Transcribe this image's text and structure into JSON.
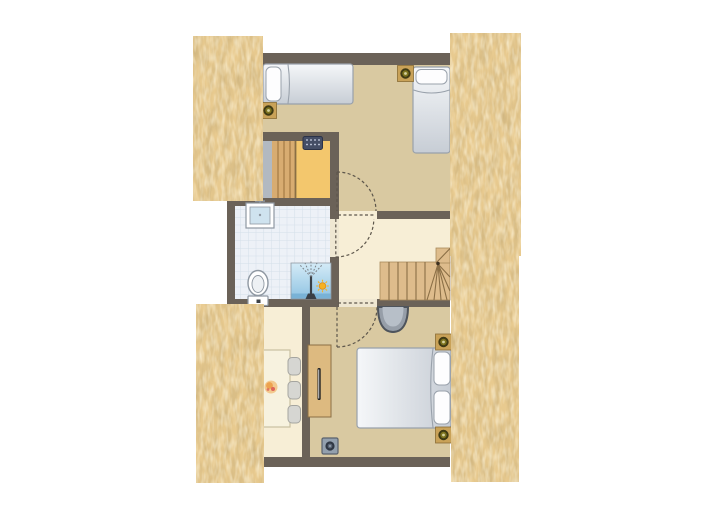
{
  "title_visible_text": "",
  "colors": {
    "bg": "#ffffff",
    "wall": "#6b6258",
    "floor_tan": "#d9c9a1",
    "floor_cream": "#f7eed6",
    "threshold": "#efe7d2",
    "sauna_floor": "#f3c76d",
    "sauna_gray": "#b2b9c1",
    "sauna_bench": "#d8ac71",
    "sauna_bench_line": "#a87e47",
    "bath_tile": "#edf1f7",
    "bath_tile_line": "#d4dfe9",
    "thatch_base": "#e8ca8f",
    "stair_wood": "#debc8c",
    "stair_edge": "#a8895c",
    "stair_line": "#8b6f46",
    "stair_newel": "#3c3020",
    "bed_light": "#f5f7f9",
    "bed_dark": "#c7cdd5",
    "bed_border": "#99a1ab",
    "pillow_white": "#fdfdfe",
    "door_dash": "#5d564b",
    "desk_wood": "#ddba80",
    "desk_edge": "#8a6f45",
    "handle_dark": "#222222",
    "handle_light": "#e8e8e8",
    "table_cream": "#f7f2df",
    "table_edge": "#c9c0a2",
    "chair_gray": "#d6d6d2",
    "chair_edge": "#a5a5a0",
    "shower_light": "#d4ebf7",
    "shower_deep": "#8fc3e2",
    "shower_strip": "#79b2d6",
    "shower_fix": "#3a3f45",
    "spray_gray": "#7d8288",
    "sun_orange": "#f6b222",
    "sun_edge": "#e2901a",
    "spot_square": "#c9a258",
    "spot_square_edge": "#8a6d35",
    "spot_dark": "#3f3a14",
    "spot_mid": "#7d741f",
    "spot_dot": "#d6d2a0",
    "heater_navy": "#454e66",
    "heater_edge": "#2b3248",
    "heater_dot": "#cfd6e8",
    "socket_fill": "#93a0ae",
    "socket_edge": "#5a626e",
    "socket_dark": "#2f3744",
    "socket_mid": "#5b6676",
    "socket_dot": "#9aa5b3",
    "basin_fill": "#969ea8",
    "basin_inner": "#b7bfc8",
    "basin_edge": "#4e545c",
    "fixture_white": "#ffffff",
    "fixture_stroke": "#8f98a2",
    "toilet_inner": "#eef1f4",
    "toilet_dot": "#3c4046",
    "sink_blue": "#cfe3ef",
    "flower_light": "#f3c98e",
    "flower_orange": "#eda24f",
    "flower_red": "#d9534f"
  },
  "semantic_elements": [
    "thatched-roof-top-left",
    "thatched-roof-top-right",
    "thatched-roof-bottom-left",
    "thatched-roof-bottom-right",
    "bedroom-top",
    "sauna",
    "bathroom",
    "landing",
    "dining-nook",
    "bedroom-bottom",
    "single-bed-horizontal",
    "single-bed-vertical",
    "double-bed",
    "sauna-bench",
    "sauna-heater-icon",
    "sink",
    "toilet",
    "shower",
    "shower-spray",
    "sun-symbol",
    "stairs-winder",
    "wall-basin",
    "desk-dresser",
    "dining-table",
    "dining-chair-1",
    "dining-chair-2",
    "dining-chair-3",
    "ceiling-spotlight-icon-1",
    "ceiling-spotlight-icon-2",
    "ceiling-spotlight-icon-3",
    "ceiling-spotlight-icon-4",
    "floor-socket-icon",
    "door-swing-bedroom-top",
    "door-swing-bathroom",
    "door-swing-bedroom-bottom",
    "flower-decoration"
  ]
}
